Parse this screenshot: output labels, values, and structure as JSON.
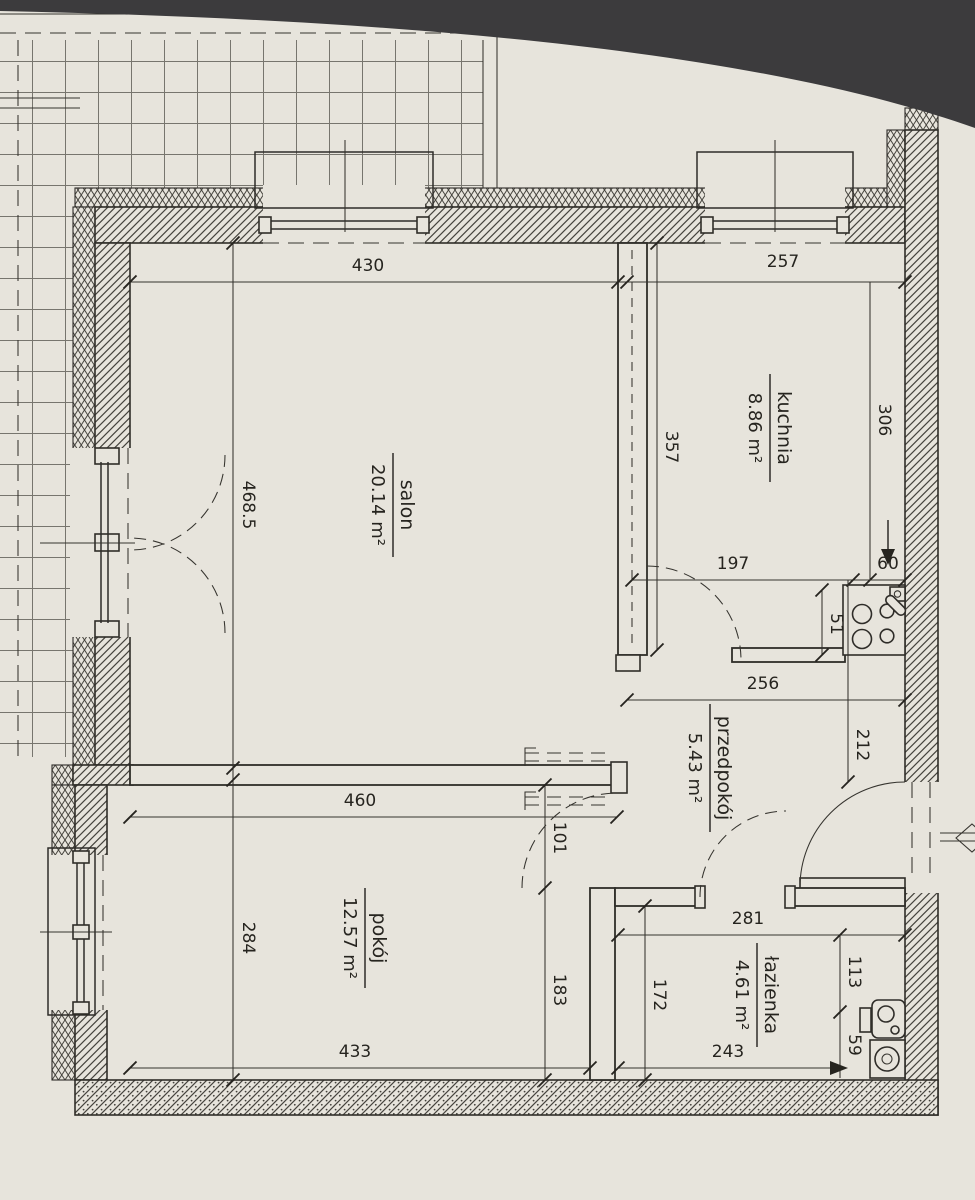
{
  "drawing": {
    "type": "apartment-floor-plan",
    "language": "pl",
    "paper_color": "#e7e4dc",
    "ink_color": "#2f2d29",
    "photo_edge_color": "#3c3b3d"
  },
  "rooms": {
    "salon": {
      "name": "salon",
      "area": "20.14 m²"
    },
    "kuchnia": {
      "name": "kuchnia",
      "area": "8.86 m²"
    },
    "przedpokoj": {
      "name": "przedpokój",
      "area": "5.43 m²"
    },
    "pokoj": {
      "name": "pokój",
      "area": "12.57 m²"
    },
    "lazienka": {
      "name": "łazienka",
      "area": "4.61 m²"
    }
  },
  "dims": {
    "salon_window": "430",
    "kuchnia_window": "257",
    "kuchnia_right": "306",
    "kuchnia_height": "357",
    "salon_height": "468.5",
    "salon_width": "460",
    "pokoj_height": "284",
    "pokoj_width": "433",
    "kuchnia_bottom": "197",
    "fridge_gap": "60",
    "counter_depth": "51",
    "przedpokoj_width": "256",
    "entry_wall": "212",
    "pokoj_door": "101",
    "pokoj_right": "183",
    "lazienka_left": "172",
    "lazienka_width": "281",
    "lazienka_right": "113",
    "fixture_gap": "59",
    "lazienka_bottom": "243"
  },
  "icons": {
    "stove": "stove-burners-icon",
    "kitchen_sink": "kitchen-sink-icon",
    "washer": "washing-machine-icon",
    "bath_sink": "bathroom-sink-icon",
    "flow_arrow_down": "arrow-down-icon",
    "flow_arrow_right": "arrow-right-icon",
    "edge_marker": "diamond-marker-icon"
  }
}
